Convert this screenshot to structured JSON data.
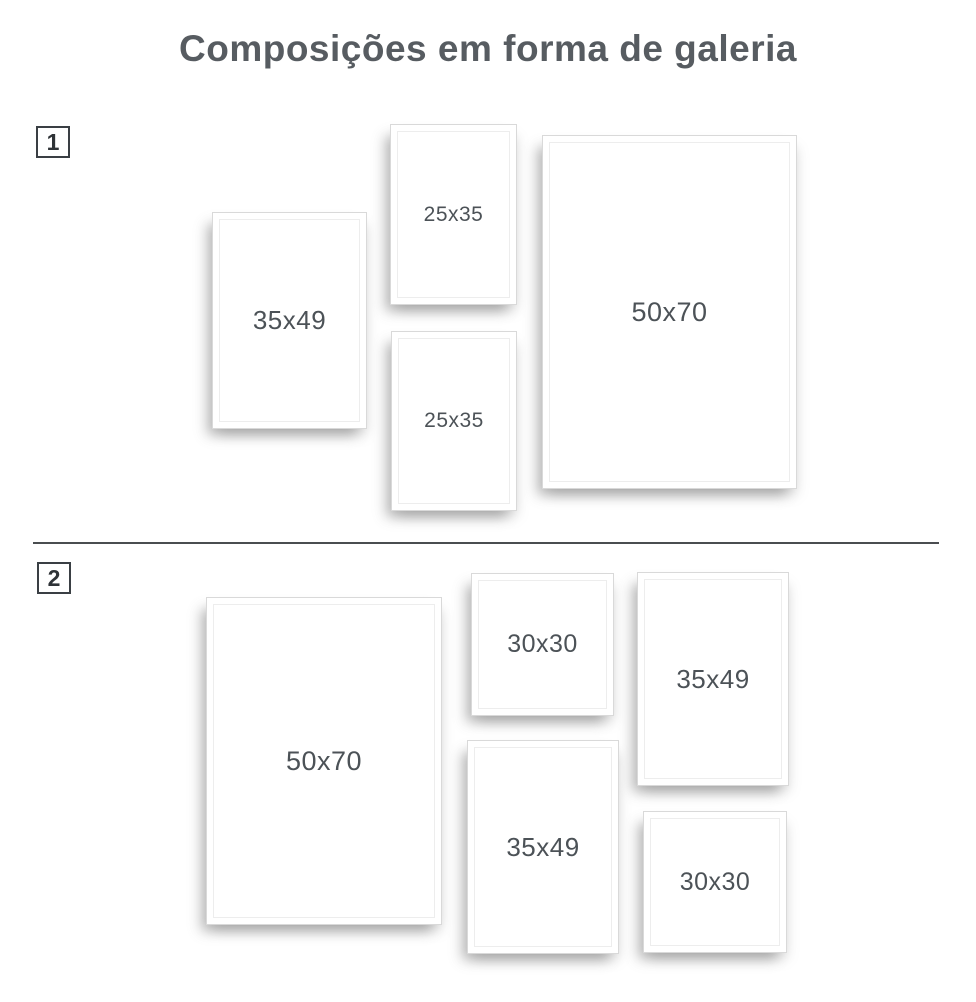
{
  "page": {
    "title": "Composições em forma de galeria"
  },
  "colors": {
    "title_text": "#575c61",
    "label_text": "#4c5257",
    "badge_border": "#3a3f44",
    "frame_border": "#d9d9d9",
    "divider": "#4a4d50",
    "background": "#ffffff"
  },
  "sections": [
    {
      "badge": "1",
      "frames": [
        {
          "label": "35x49"
        },
        {
          "label": "25x35"
        },
        {
          "label": "25x35"
        },
        {
          "label": "50x70"
        }
      ]
    },
    {
      "badge": "2",
      "frames": [
        {
          "label": "50x70"
        },
        {
          "label": "30x30"
        },
        {
          "label": "35x49"
        },
        {
          "label": "35x49"
        },
        {
          "label": "30x30"
        }
      ]
    }
  ]
}
